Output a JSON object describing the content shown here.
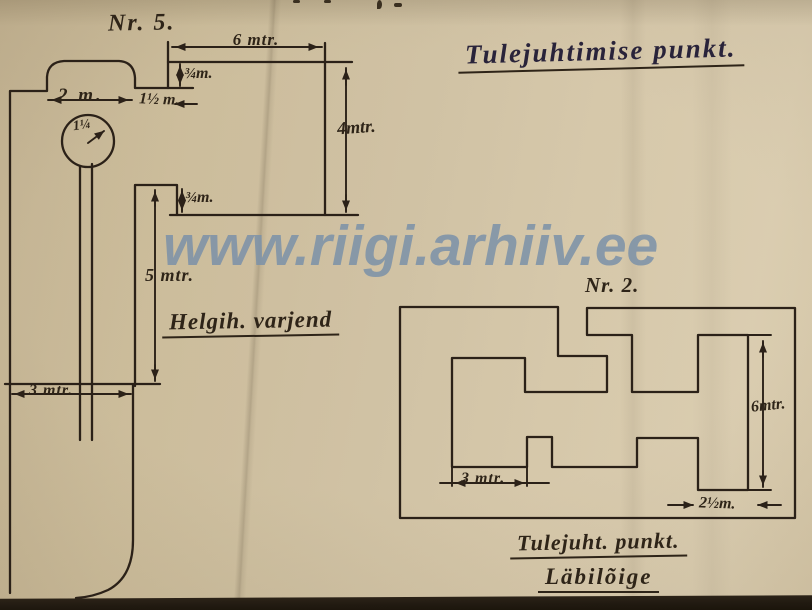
{
  "watermark": {
    "text": "www.riigi.arhiiv.ee",
    "color": "#7a90a8"
  },
  "page_title": {
    "text": "Tulejuhtimise punkt."
  },
  "left_diagram": {
    "number": "Nr. 5.",
    "caption": "Helgih. varjend",
    "dims": {
      "top_width": "6 mtr.",
      "roof_thickness_top": "¾m.",
      "dome_width": "2 m.",
      "step_width": "1½ m.",
      "circle_diameter": "1¼",
      "right_height": "4mtr.",
      "roof_thickness_bottom": "¾m.",
      "left_height": "5 mtr.",
      "base_width": "3 mtr."
    }
  },
  "right_diagram": {
    "number": "Nr. 2.",
    "caption_line1": "Tulejuht. punkt.",
    "caption_line2": "Läbilõige",
    "dims": {
      "inner_height": "6mtr.",
      "room_width": "3 mtr.",
      "wall_width": "2½m."
    }
  },
  "colors": {
    "paper": "#cdbe9e",
    "ink": "#2b2118",
    "title_ink": "#29233a",
    "watermark_blue": "#7a90a8",
    "bottom_strip": "#211a11"
  }
}
